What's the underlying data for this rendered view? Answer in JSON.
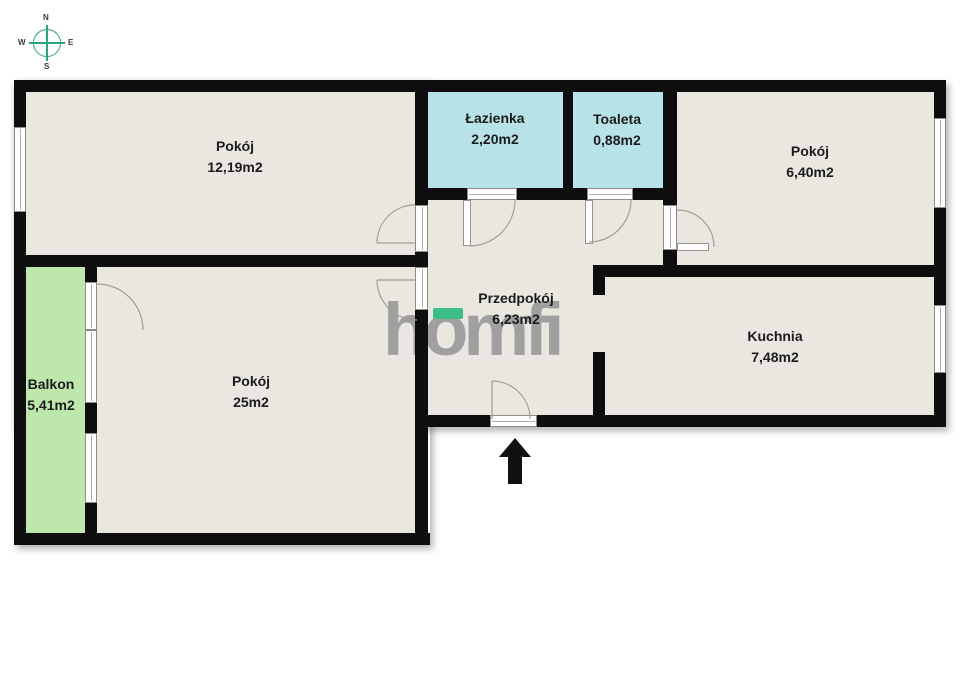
{
  "compass": {
    "north": "N",
    "east": "E",
    "south": "S",
    "west": "W"
  },
  "watermark": {
    "text": "homfi",
    "text_color": "#9B9B9B",
    "accent_color": "#3DBE86"
  },
  "rooms": [
    {
      "id": "pokoj-12",
      "name": "Pokój",
      "area": "12,19m2"
    },
    {
      "id": "lazienka",
      "name": "Łazienka",
      "area": "2,20m2"
    },
    {
      "id": "toaleta",
      "name": "Toaleta",
      "area": "0,88m2"
    },
    {
      "id": "pokoj-6",
      "name": "Pokój",
      "area": "6,40m2"
    },
    {
      "id": "przedpokoj",
      "name": "Przedpokój",
      "area": "6,23m2"
    },
    {
      "id": "kuchnia",
      "name": "Kuchnia",
      "area": "7,48m2"
    },
    {
      "id": "pokoj-25",
      "name": "Pokój",
      "area": "25m2"
    },
    {
      "id": "balkon",
      "name": "Balkon",
      "area": "5,41m2"
    }
  ],
  "colors": {
    "wall": "#0E0E0E",
    "floor": "#EAE7E0",
    "wet_room": "#B6E2E8",
    "balcony": "#BEE7AE",
    "compass_green": "#2BA57C"
  },
  "entrance": {
    "direction": "up"
  }
}
